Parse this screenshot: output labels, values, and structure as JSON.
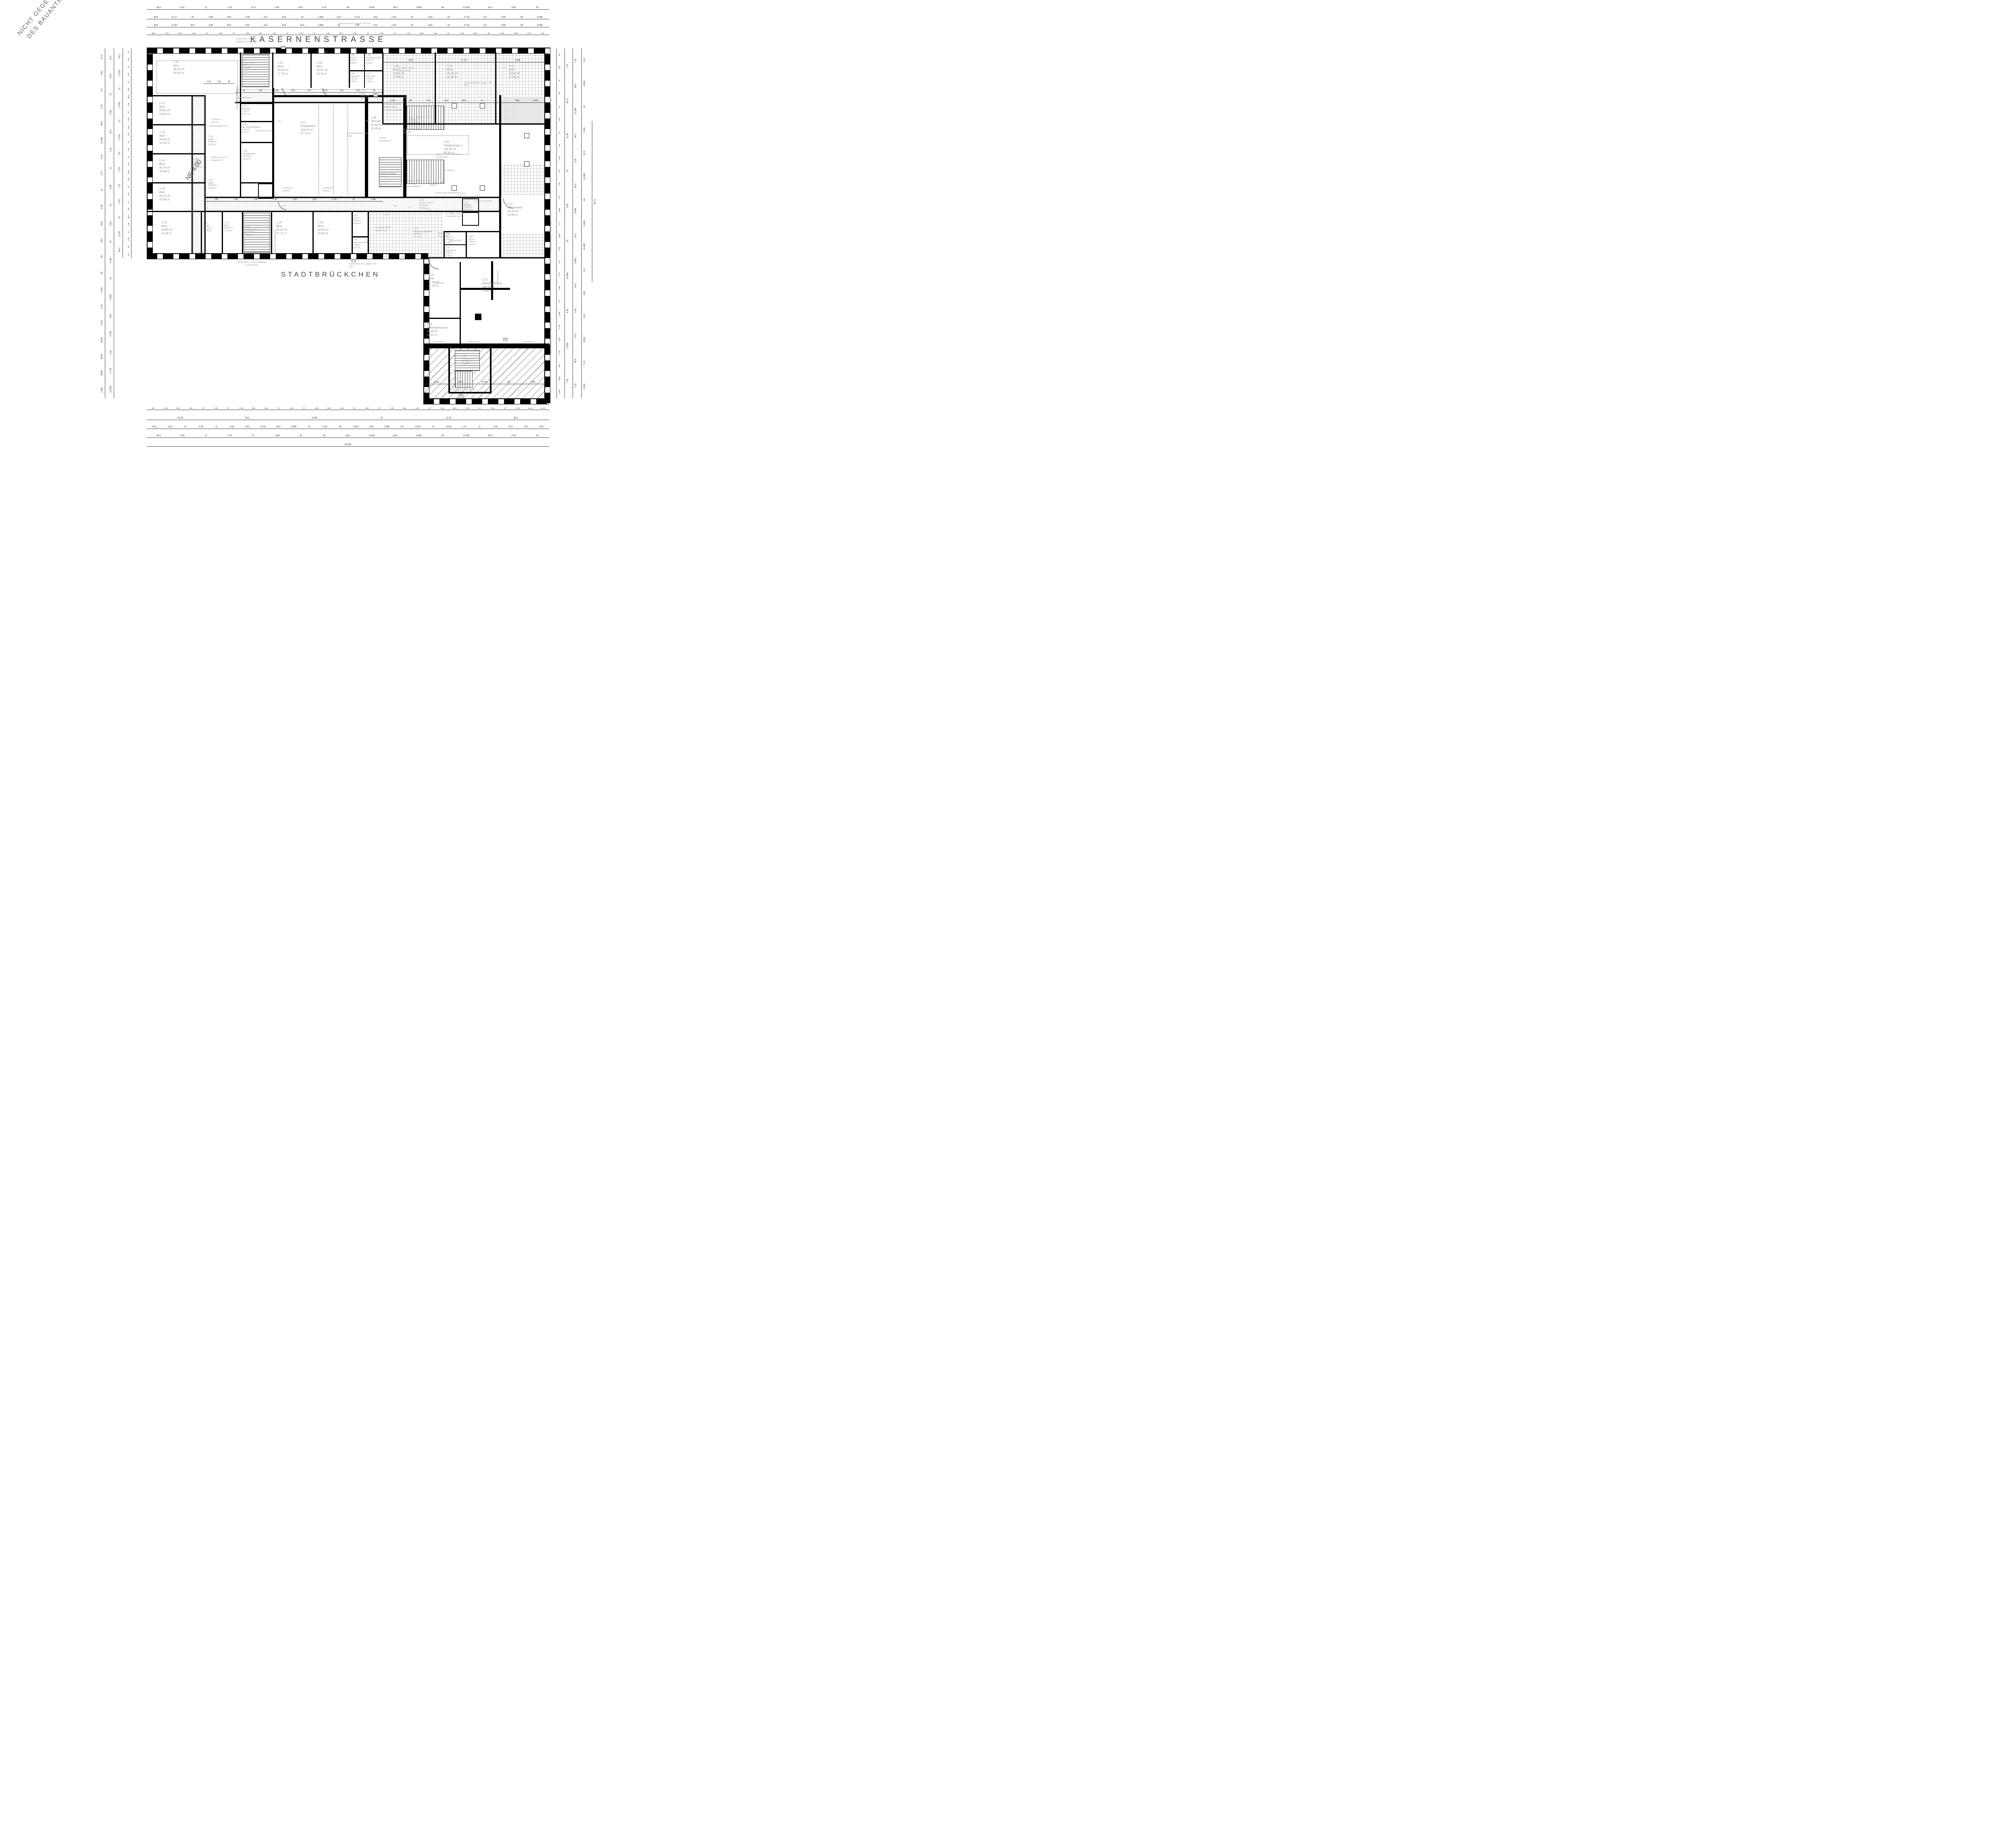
{
  "streets": {
    "top": "KASERNENSTRASSE",
    "bottom": "STADTBRÜCKCHEN"
  },
  "rooms": {
    "r1_01": {
      "num": "1.01",
      "name": "Büro",
      "area": "19.05 m²",
      "perim": "17.59 m"
    },
    "r1_02": {
      "num": "1.02",
      "name": "Büro",
      "area": "28.26 m²",
      "perim": "21.38 m"
    },
    "r1_03": {
      "num": "1.03",
      "name": "Büro",
      "area": "19.92 m²",
      "perim": "17.95 m"
    },
    "r1_05": {
      "num": "1.05",
      "name": "Vorraum D-WC",
      "area": "5.32 m²",
      "perim": "9.33 m"
    },
    "r1_06": {
      "num": "1.06",
      "name": "WC-D",
      "area": "4.92 m²",
      "perim": "9.03 m"
    },
    "r1_07": {
      "num": "1.07",
      "name": "Beh.-WC",
      "area": "4.18 m²",
      "perim": "8.18 m"
    },
    "r1_08": {
      "num": "1.08",
      "name": "Teeküche",
      "area": "2.91 m²",
      "perim": "6.82 m"
    },
    "r1_09": {
      "num": "1.09",
      "name": "Büro",
      "area": "16.97 m²",
      "perim": "16.76 m"
    },
    "r1_10": {
      "num": "1.10",
      "name": "Büro",
      "area": "18.40 m²",
      "perim": "17.75 m"
    },
    "r1_11": {
      "num": "1.11",
      "name": "Büro",
      "area": "58.35 m²",
      "perim": "33.83 m"
    },
    "r1_12": {
      "num": "1.12",
      "name": "Büro",
      "area": "20.64 m²",
      "perim": "18.53 m"
    },
    "r1_13": {
      "num": "1.13",
      "name": "Büro",
      "area": "20.64 m²",
      "perim": "18.53 m"
    },
    "r1_14": {
      "num": "1.14",
      "name": "Büro",
      "area": "20.78 m²",
      "perim": "18.58 m"
    },
    "r1_15": {
      "num": "1.15",
      "name": "Büro",
      "area": "20.78 m²",
      "perim": "18.58 m"
    },
    "r1_16": {
      "num": "1.16",
      "name": "Büro",
      "area": "28.84 m²",
      "perim": "21.49 m"
    },
    "r1_17": {
      "num": "1.17",
      "name": "Lager",
      "area": "10.11 m²",
      "perim": "13.99 m"
    },
    "r1_18": {
      "num": "1.18",
      "name": "Büro",
      "area": "18.60 m²",
      "perim": "17.76 m"
    },
    "r1_19": {
      "num": "1.19",
      "name": "Büro",
      "area": "18.60 m²",
      "perim": "17.71 m"
    },
    "r1_20": {
      "num": "1.20",
      "name": "Büro",
      "area": "26.55 m²",
      "perim": "20.62 m"
    },
    "r1_21": {
      "num": "1.21",
      "name": "Vorraum H-WC",
      "area": "2.58 m²",
      "perim": "6.52 m"
    },
    "r1_22": {
      "num": "1.22",
      "name": "WC-H",
      "area": "6.28 m²",
      "perim": "10.68 m"
    },
    "r1_23": {
      "num": "1.23",
      "name": "Besprechungsraum",
      "area": "52.59 m²",
      "perim": "31.12 m"
    },
    "r1_24": {
      "num": "1.24",
      "name": "Aufenthaltsraum",
      "area": "136.74 m²",
      "perim": "79.68 m"
    },
    "r1_25": {
      "num": "1.25",
      "name": "Büro",
      "area": "17.91 m²",
      "perim": "17.02 m"
    },
    "r1_26": {
      "num": "1.26",
      "name": "Aufenthaltsraum",
      "area": "25.86 m²",
      "perim": "21.67 m"
    },
    "r1_27": {
      "num": "1.27",
      "name": "Altenservice",
      "area": "13.10 m²",
      "perim": "14.48 m"
    },
    "r1_28": {
      "num": "1.28",
      "name": "WC-D",
      "area": "6.95 m²",
      "perim": "11.41 m"
    },
    "r1_29": {
      "num": "1.29",
      "name": "Vorraum W",
      "area": "2.46 m²",
      "perim": "6.76 m"
    },
    "r1_30": {
      "num": "1.30",
      "name": "WC-H",
      "area": "3.57 m²",
      "perim": "7.64 m"
    },
    "r1_31": {
      "num": "1.21",
      "name": "Aufzug",
      "area": "10.80 m²",
      "perim": "13.16 m"
    },
    "r1_34": {
      "num": "1.34",
      "name": "Schacht",
      "area": "7.03 m²",
      "perim": "11.67 m"
    },
    "r1_35": {
      "num": "1.35",
      "name": "Flur",
      "area": "69.16 m²",
      "perim": "76.93 m"
    },
    "r1_36": {
      "num": "1.36",
      "name": "Technik",
      "area": "40.64 m²",
      "perim": "30.45 m"
    },
    "r1_37": {
      "num": "1.37",
      "name": "Probebühne",
      "area": "164.10 m²",
      "perim": "51.73 m"
    },
    "r1_38": {
      "num": "1.38",
      "name": "Lager",
      "area": "19.38 m²",
      "perim": "22.91 m"
    },
    "r1_39": {
      "num": "1.39",
      "name": "Lager",
      "area": "24.68 m²",
      "perim": "21.89 m"
    },
    "r1_40": {
      "num": "1.40",
      "name": "Klimatechnik",
      "area": "33.69 m²",
      "perim": "28.41 m"
    },
    "r1_41": {
      "num": "1.41",
      "name": "Be- und Entlüftung",
      "area": "4.19 m²",
      "perim": "9.70 m"
    },
    "r1_50": {
      "num": "1.50",
      "name": "Treppenhaus 3",
      "area": "130.35 m²",
      "perim": "46.96 m"
    },
    "r1_52": {
      "num": "1.52",
      "name": "Treppenhaus 1",
      "area": "22.14 m²",
      "perim": "22.01 m"
    },
    "r1_53": {
      "num": "1.53",
      "name": "Flur",
      "area": "49.1 m²",
      "perim": "50.72 m"
    },
    "r1_54": {
      "num": "1.54",
      "name": "Treppenhaus",
      "area": "22.17 m²",
      "perim": "21.94 m"
    },
    "r1_55": {
      "num": "1.55",
      "name": "Flur",
      "area": "48.52 m²",
      "perim": "58.07 m"
    },
    "r1_56": {
      "num": "1.56",
      "name": "Treppenhaus",
      "area": "21.12 m²",
      "perim": "9.60 m"
    }
  },
  "annotations": {
    "not_part_1": "NICHT GEGENSTAND",
    "not_part_2": "DES BAUANTRAGS",
    "deckenschuerze": "Deckenschürze, abgeh. GK F30",
    "bauart_brandwand": "Bauart einer Brandwand",
    "brandwand": "Brandwand",
    "gk_decke": "GK-Decke 10cm",
    "beton_parkett": "D. Beton B. Parkett",
    "beton_estrich": "D. Beton B. Estrich",
    "beton_estrich_neu": "D. Beton B. Beton, Estrich neu",
    "abgeh_rd_teppich": "D. abgeh. RD B. Teppich neu",
    "abgeh_gk_kautschuk": "D. abgeh. GK F30 B. Kautschuk neu",
    "abgeh_gk_fliesen": "D. abgeh. GK B. Fliesen",
    "podest": "Podest demontieren",
    "treppen_note": "Treppen: jeweils 1. und letzte Stufe kontrastfarben",
    "projektionswand": "Projektionswand f. Beamer gem. Fachplanung Elektro",
    "deckenverspruenge": "Deckenversprünge schließen",
    "beamer": "Beamer gem. Abstimmung Bauaufsicht",
    "luftraum": "Luftraum",
    "bodenverteilung": "Bodenverteilung gem. Statik",
    "bodentank": "Bodentank-Ausschnitt",
    "rettungsweg": "2. Rettungsweg",
    "absturz": "Absturzsicherung an Fenster gem. LBO",
    "fenster_note": "FENSTER >= 0,5 m² öffenbar je Geschoss",
    "garderobe": "Garderobe",
    "kabeltrassen": "Kabeltrassen",
    "steigeschacht": "Steigeschacht/ Elektro",
    "glaswand": "GLASWAND",
    "austrittspodest": "Austrittspodest neu",
    "abstimmung": "Abstimmung mit Bauaufsicht",
    "motorantrieb": "Motorantrieb",
    "ne_400": "NE 4.00",
    "f90": "F90",
    "f30": "F30",
    "t30rs": "T30RS",
    "na": "NA",
    "dt": "DT"
  },
  "dims": {
    "top1": [
      "40.5",
      "5.52",
      "11",
      "1.78",
      "12.5",
      "3.64",
      "24.5",
      "4.13",
      "45",
      "14.40",
      "45.5",
      "3.465",
      "40",
      "11.525",
      "19.5",
      "4.04",
      "62"
    ],
    "top2": [
      "40.5",
      "11.17",
      "78",
      "3.09",
      "78.5",
      "3.38",
      "13.5",
      "3.42",
      "16",
      "1.695",
      "14.5",
      "2.115",
      "14.5",
      "1.50",
      "10",
      "4.03",
      "10",
      "5.715",
      "9.5",
      "3.85",
      "28",
      "8.305"
    ],
    "top3": [
      "40.5",
      "11.69",
      "25.5",
      "3.09",
      "25.5",
      "3.91",
      "13.5",
      "3.42",
      "14.5",
      "1.835",
      "13",
      "1.99",
      "13.5",
      "1.50",
      "10",
      "4.03",
      "10",
      "5.715",
      "9.5",
      "3.85",
      "28",
      "8.305"
    ],
    "top4": [
      "85.5",
      "1.06",
      "86.5",
      "1.06",
      "87",
      "1.05",
      "87",
      "1.06",
      "86.5",
      "1.06",
      "87",
      "1.05",
      "87",
      "1.06",
      "86.5",
      "1.06",
      "87",
      "1.05",
      "87",
      "1.06",
      "86.5",
      "1.06",
      "87",
      "1.06",
      "86.5",
      "62",
      "2.82",
      "1.015",
      "2.81",
      "1.04"
    ],
    "bottom1": [
      "88",
      "1.05",
      "84.5",
      "1.06",
      "87",
      "1.05",
      "87",
      "1.06",
      "86.5",
      "1.06",
      "87",
      "1.05",
      "87",
      "1.06",
      "86.5",
      "1.06",
      "87",
      "1.05",
      "87",
      "1.06",
      "86.5",
      "1.06",
      "87",
      "1.06",
      "86.5",
      "1.06",
      "87",
      "1.05",
      "87",
      "1.06",
      "16.42",
      "16.44"
    ],
    "bottom2": [
      "35.06",
      "69.5",
      "3.955",
      "10",
      "11.21",
      "28.5"
    ],
    "bottom3": [
      "40.5",
      "5.53",
      "11",
      "2.04",
      "11",
      "3.93",
      "23.5",
      "3.075",
      "30.5",
      "3.895",
      "10",
      "5.35",
      "28",
      "1.915",
      "14.5",
      "1.505",
      "9.5",
      "10.60",
      "10",
      "3.015",
      "1.77",
      "11",
      "1.38",
      "19.5",
      "3.97",
      "28.5"
    ],
    "bottom4": [
      "40.5",
      "5.53",
      "11",
      "1.78",
      "27",
      "7.695",
      "18",
      "45",
      "36.5",
      "14.04",
      "45.5",
      "3.465",
      "40",
      "11.525",
      "19.5",
      "4.04",
      "62"
    ],
    "bottom5": [
      "51.505"
    ],
    "left1": [
      "41.5",
      "4.96",
      "9.5",
      "1.76",
      "40.5",
      "11.465",
      "41.5",
      "1.77",
      "11",
      "4.96",
      "40.5",
      "60.5",
      "66",
      "88",
      "2.785",
      "1.05",
      "2.775",
      "18.95",
      "18.95",
      "18.85",
      "7.825"
    ],
    "left2": [
      "41.5",
      "4.93",
      "11",
      "1.785",
      "13.5",
      "1.21",
      "11",
      "6.95",
      "12",
      "3.63",
      "12",
      "1.785",
      "10",
      "4.955",
      "40.5",
      "2.785",
      "1.05",
      "2.775",
      "14.995"
    ],
    "left3": [
      "41.5",
      "5.225",
      "11",
      "3.735",
      "12",
      "3.735",
      "9.5",
      "3.76",
      "9.5",
      "3.76",
      "10",
      "5.215",
      "40.5"
    ],
    "left4": [
      "78",
      "1.06",
      "32",
      "1.05",
      "87",
      "1.06",
      "86.5",
      "1.06",
      "87",
      "1.06",
      "86.5",
      "1.06",
      "87",
      "1.05",
      "87",
      "1.06",
      "86.5",
      "1.06",
      "87",
      "1.05",
      "87",
      "1.06",
      "86.5",
      "1.06",
      "87",
      "1.05",
      "88",
      "66"
    ],
    "right1": [
      "88",
      "1.06",
      "32",
      "1.05",
      "87",
      "1.06",
      "34",
      "1.06",
      "1.075",
      "47.5",
      "1.06",
      "2.76",
      "1.085",
      "2.77",
      "1.085",
      "2.725",
      "1.12",
      "2.775",
      "1.085",
      "2.77",
      "1.065",
      "2.785",
      "1.075",
      "2.775",
      "96.5",
      "3.555",
      "3.235"
    ],
    "right2": [
      "7.11",
      "62.5",
      "11.36",
      "10",
      "3.65",
      "10",
      "14.995",
      "8.35",
      "8.555",
      "7.51"
    ],
    "right3": [
      "7.11",
      "59.5",
      "11.395",
      "42.5",
      "3.15",
      "46.5",
      "3.945",
      "14.5",
      "1.895",
      "14.5",
      "2.66",
      "13.5",
      "96.5",
      "7.13"
    ],
    "right4": [
      "41.5",
      "4.945",
      "10",
      "2.245",
      "31.5",
      "11.065",
      "44",
      "6.045",
      "11.695",
      "9.5",
      "2.66",
      "13.5",
      "3.555",
      "7.13",
      "3.235"
    ],
    "right_total": [
      "45.71"
    ],
    "corr155": [
      "34",
      "1.55",
      "1.55",
      "1.55",
      "1.55",
      "1.55",
      "1.55",
      "1.55",
      "34"
    ],
    "corr135": [
      "1.55",
      "1.55",
      "1.55",
      "1.55",
      "1.55",
      "1.55",
      "1.725",
      "32",
      "1.085"
    ],
    "grid1": [
      "4.03",
      "5.715",
      "3.845"
    ],
    "grid2": [
      "2.395",
      "88",
      "74.5",
      "4.07",
      "88.5",
      "76",
      "76",
      "88.5",
      "2.205"
    ],
    "inner1": [
      "1.55",
      "1.55",
      "62"
    ],
    "stadtb": [
      "3.225",
      "25.5",
      "5.615",
      "50",
      "5.58"
    ]
  }
}
